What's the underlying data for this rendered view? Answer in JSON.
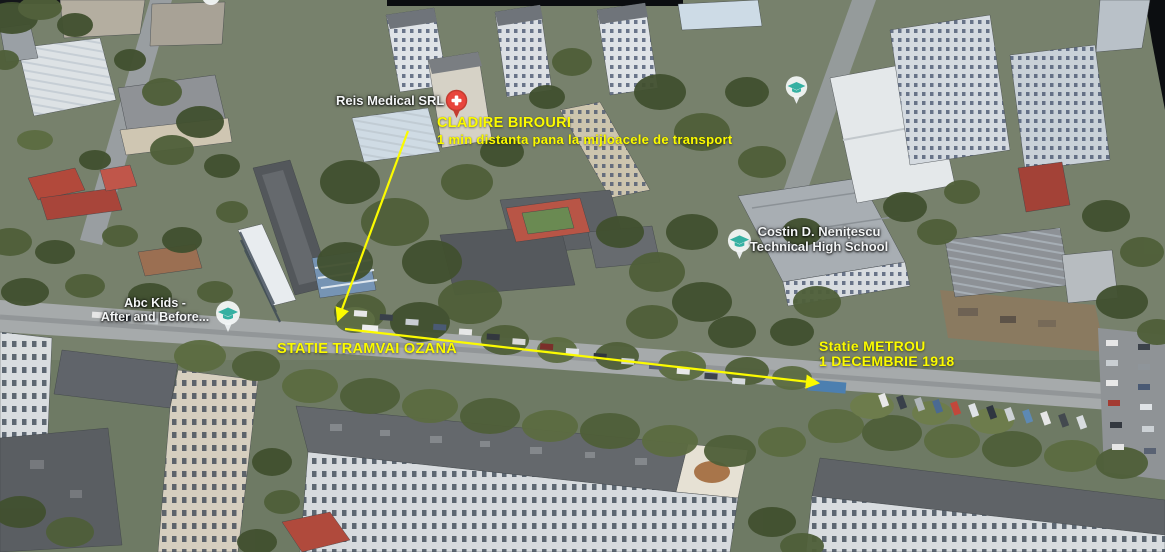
{
  "view": {
    "type": "3D aerial map with route annotations"
  },
  "annotations": {
    "color": "#fbfb00",
    "office": {
      "title": "CLADIRE BIROURI",
      "subtitle": "1 min distanta pana la mijloacele de transport"
    },
    "tram_stop": {
      "label": "STATIE TRAMVAI OZANA"
    },
    "metro_stop": {
      "line1": "Statie METROU",
      "line2": "1 DECEMBRIE 1918"
    },
    "arrows": [
      {
        "name": "office-to-tram",
        "from": [
          408,
          131
        ],
        "to": [
          338,
          320
        ]
      },
      {
        "name": "tram-to-metro",
        "from": [
          345,
          329
        ],
        "to": [
          818,
          383
        ]
      }
    ]
  },
  "poi": {
    "medical": {
      "label": "Reis Medical SRL",
      "icon": "medical-cross-pin",
      "color": "#e8453c"
    },
    "kindergarten": {
      "line1": "Abc Kids -",
      "line2": "After and Before...",
      "icon": "school-pin",
      "color": "#35b0a2"
    },
    "high_school": {
      "line1": "Costin D. Nenițescu",
      "line2": "Technical High School",
      "icon": "school-pin",
      "color": "#35b0a2"
    },
    "school_unlabeled": {
      "icon": "school-pin",
      "color": "#35b0a2"
    }
  }
}
